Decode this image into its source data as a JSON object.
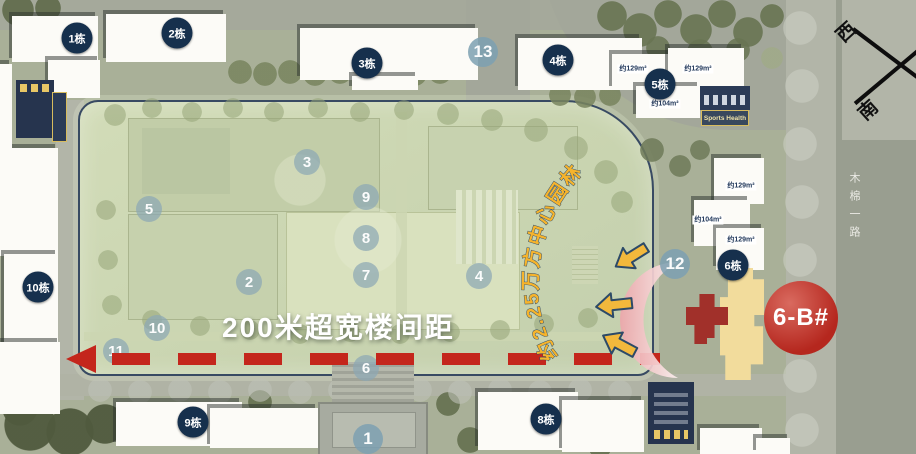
{
  "annotations": {
    "distance_label": "200米超宽楼间距",
    "garden_label": "约2.25万方中心园林",
    "unit_badge": "6-B#",
    "road_name": "木棉一路",
    "sports_health_label": "Sports Health"
  },
  "compass": {
    "west": "西",
    "south": "南"
  },
  "building_badges": [
    {
      "label": "1栋"
    },
    {
      "label": "2栋"
    },
    {
      "label": "3栋"
    },
    {
      "label": "4栋"
    },
    {
      "label": "5栋"
    },
    {
      "label": "6栋"
    },
    {
      "label": "8栋"
    },
    {
      "label": "9栋"
    },
    {
      "label": "10栋"
    }
  ],
  "node_badges": [
    {
      "label": "1"
    },
    {
      "label": "2"
    },
    {
      "label": "3"
    },
    {
      "label": "4"
    },
    {
      "label": "5"
    },
    {
      "label": "6"
    },
    {
      "label": "7"
    },
    {
      "label": "8"
    },
    {
      "label": "9"
    },
    {
      "label": "10"
    },
    {
      "label": "11"
    },
    {
      "label": "12"
    },
    {
      "label": "13"
    }
  ],
  "area_labels": [
    {
      "label": "约129m²"
    },
    {
      "label": "约129m²"
    },
    {
      "label": "约104m²"
    },
    {
      "label": "约129m²"
    },
    {
      "label": "约104m²"
    },
    {
      "label": "约129m²"
    }
  ],
  "colors": {
    "accent_red": "#c4261c",
    "badge_navy": "#16304d",
    "badge_teal": "#8ca8b4",
    "highlight_yellow": "#f2b83c",
    "building_yellow": "#f2dc9c",
    "cross_red": "#a1302a",
    "garden_green": "#ccd6b3",
    "road_gray": "#999e90"
  }
}
